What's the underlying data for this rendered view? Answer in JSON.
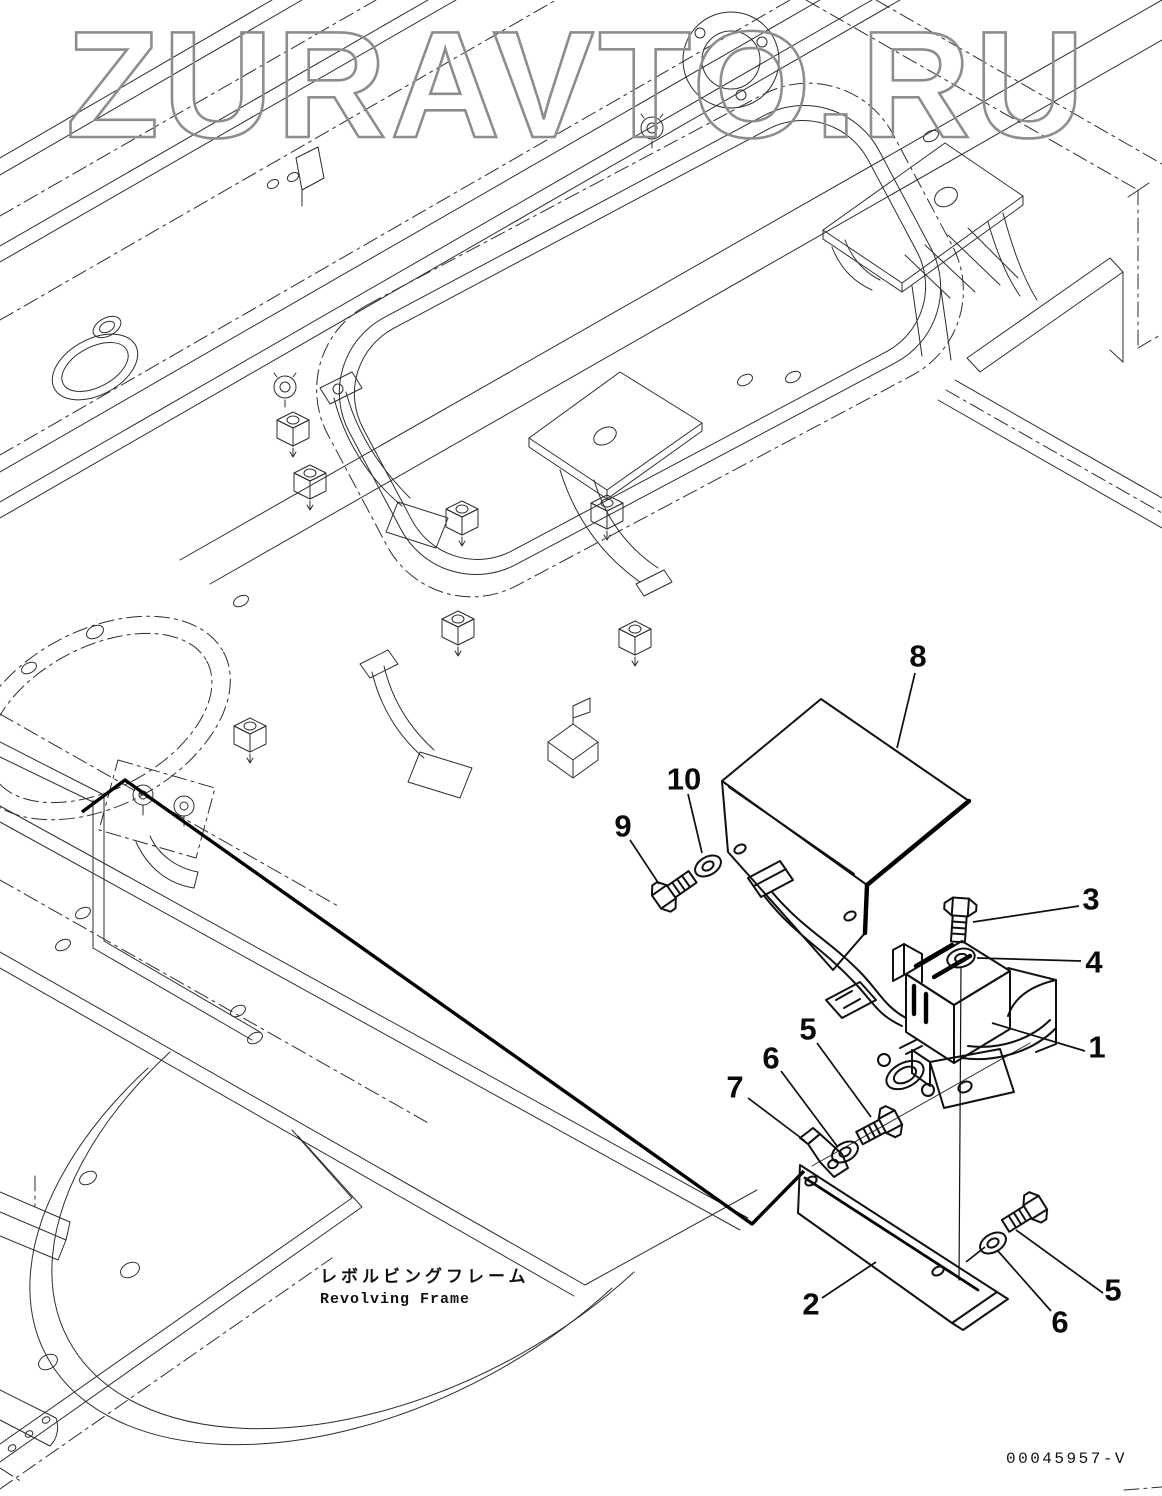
{
  "watermark": "ZURAVTO.RU",
  "figure": {
    "caption_jp": "レボルビングフレーム",
    "caption_en": "Revolving Frame",
    "drawing_number": "00045957-V"
  },
  "callouts": [
    {
      "label": "8",
      "cx": 918,
      "cy": 656
    },
    {
      "label": "10",
      "cx": 684,
      "cy": 779
    },
    {
      "label": "9",
      "cx": 623,
      "cy": 826
    },
    {
      "label": "3",
      "cx": 1091,
      "cy": 899
    },
    {
      "label": "4",
      "cx": 1094,
      "cy": 962
    },
    {
      "label": "1",
      "cx": 1097,
      "cy": 1047
    },
    {
      "label": "5",
      "cx": 808,
      "cy": 1029
    },
    {
      "label": "6",
      "cx": 771,
      "cy": 1058
    },
    {
      "label": "7",
      "cx": 735,
      "cy": 1087
    },
    {
      "label": "2",
      "cx": 811,
      "cy": 1304
    },
    {
      "label": "5",
      "cx": 1113,
      "cy": 1290
    },
    {
      "label": "6",
      "cx": 1060,
      "cy": 1322
    }
  ]
}
